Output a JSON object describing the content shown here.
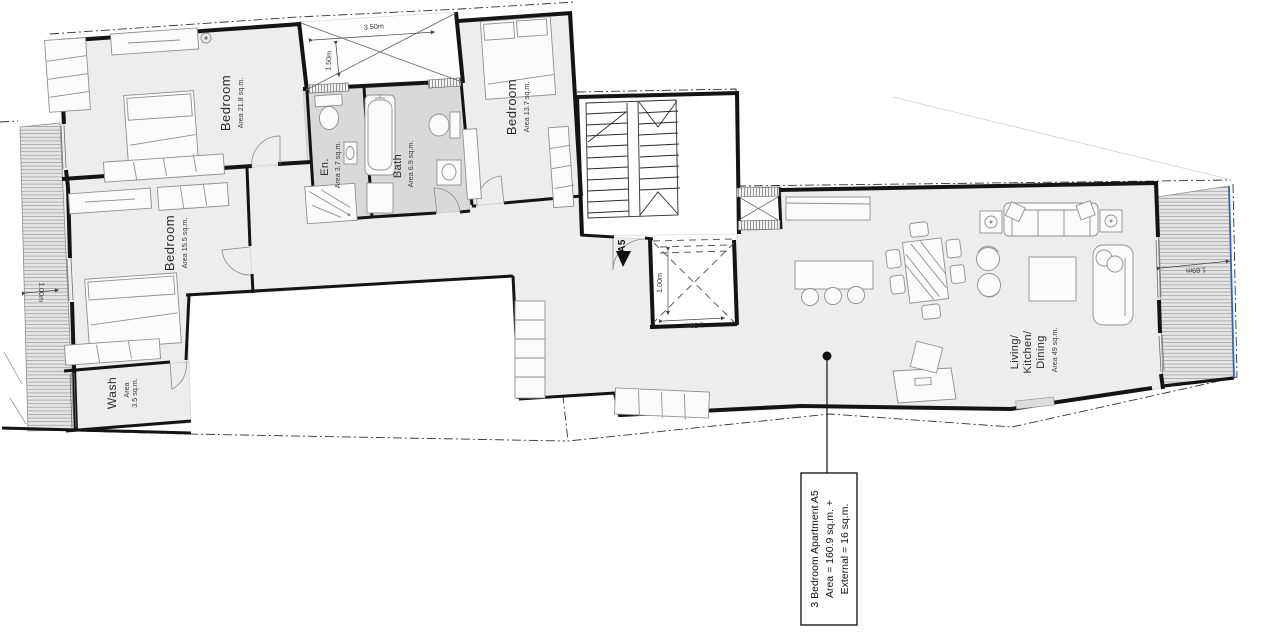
{
  "colors": {
    "wall": "#141414",
    "floor": "#ededed",
    "wet_floor": "#d9d9d9",
    "balcony_hatch": "#e6e6e6",
    "boundary_blue": "#2f63c8"
  },
  "labels": {
    "bedroom1": {
      "name": "Bedroom",
      "area": "Area 21.8 sq.m."
    },
    "bedroom2": {
      "name": "Bedroom",
      "area": "Area 13.7 sq.m."
    },
    "bedroom3": {
      "name": "Bedroom",
      "area": "Area 15.5 sq.m."
    },
    "wash": {
      "name": "Wash",
      "area_word": "Area",
      "area_value": "3.5 sq.m."
    },
    "ensuite": {
      "name": "En.",
      "area": "Area 3.7 sq.m."
    },
    "bath": {
      "name": "Bath",
      "area": "Area 6.9 sq.m."
    },
    "living": {
      "name_line1": "Living/",
      "name_line2": "Kitchen/",
      "name_line3": "Dining",
      "area": "Area 49 sq.m."
    }
  },
  "dimensions": {
    "terrace_width": "3.50m",
    "terrace_depth": "1.50m",
    "lightwell_depth": "1.00m",
    "lightwell_width": "1.59m",
    "left_balcony_width": "1.00m",
    "right_balcony_width": "1.89m"
  },
  "entrance": {
    "label": "A5"
  },
  "annotation": {
    "line1": "3 Bedroom Apartment  A5",
    "line2": "Area = 160.9 sq.m. +",
    "line3": "External = 16 sq.m."
  }
}
